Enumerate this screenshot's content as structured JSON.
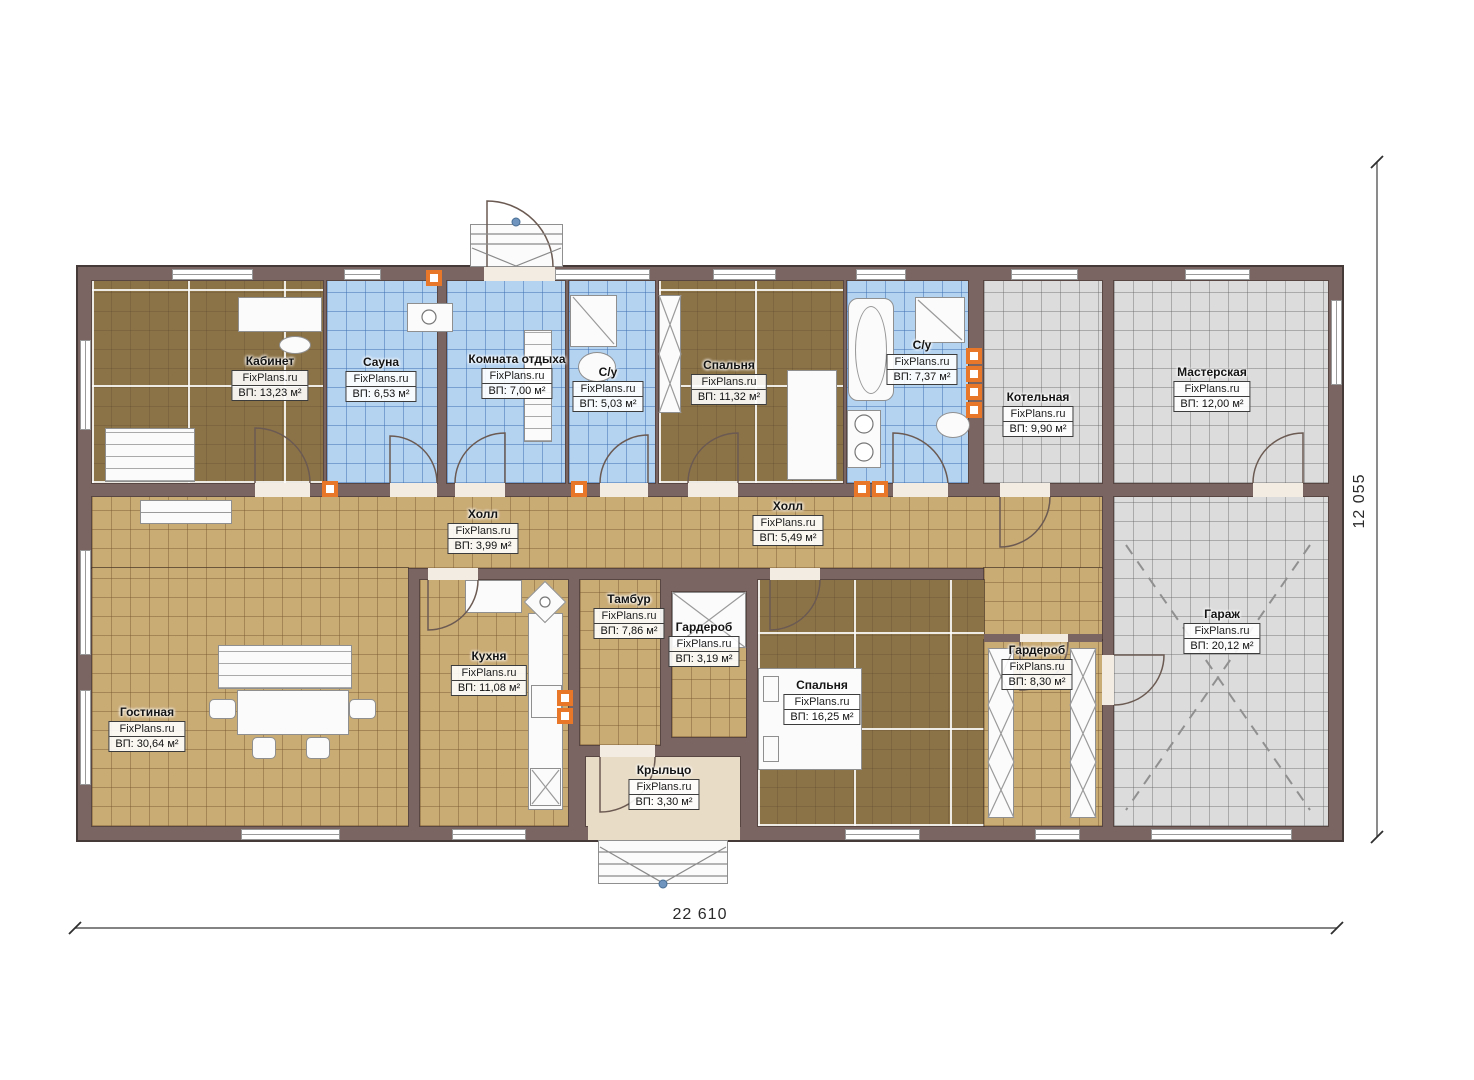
{
  "plan": {
    "watermark": "FixPlans.ru",
    "rooms": [
      {
        "id": "kabinet",
        "name": "Кабинет",
        "area": "ВП: 13,23 м²"
      },
      {
        "id": "sauna",
        "name": "Сауна",
        "area": "ВП: 6,53 м²"
      },
      {
        "id": "komnata-otdyha",
        "name": "Комната отдыха",
        "area": "ВП: 7,00 м²"
      },
      {
        "id": "su-1",
        "name": "С/у",
        "area": "ВП: 5,03 м²"
      },
      {
        "id": "spalnya-1",
        "name": "Спальня",
        "area": "ВП: 11,32 м²"
      },
      {
        "id": "su-2",
        "name": "С/у",
        "area": "ВП: 7,37 м²"
      },
      {
        "id": "kotelnaya",
        "name": "Котельная",
        "area": "ВП: 9,90 м²"
      },
      {
        "id": "masterskaya",
        "name": "Мастерская",
        "area": "ВП: 12,00 м²"
      },
      {
        "id": "holl-1",
        "name": "Холл",
        "area": "ВП: 3,99 м²"
      },
      {
        "id": "holl-2",
        "name": "Холл",
        "area": "ВП: 5,49 м²"
      },
      {
        "id": "tambur",
        "name": "Тамбур",
        "area": "ВП: 7,86 м²"
      },
      {
        "id": "garderob-1",
        "name": "Гардероб",
        "area": "ВП: 3,19 м²"
      },
      {
        "id": "kuhnya",
        "name": "Кухня",
        "area": "ВП: 11,08 м²"
      },
      {
        "id": "gostinaya",
        "name": "Гостиная",
        "area": "ВП: 30,64 м²"
      },
      {
        "id": "spalnya-2",
        "name": "Спальня",
        "area": "ВП: 16,25 м²"
      },
      {
        "id": "garderob-2",
        "name": "Гардероб",
        "area": "ВП: 8,30 м²"
      },
      {
        "id": "garazh",
        "name": "Гараж",
        "area": "ВП: 20,12 м²"
      },
      {
        "id": "kryltso",
        "name": "Крыльцо",
        "area": "ВП: 3,30 м²"
      }
    ],
    "dimensions": {
      "width": "22 610",
      "height": "12 055"
    },
    "colors": {
      "wall": "#7b6562",
      "floor_tan": "#c9ab74",
      "floor_blue": "#b4d3f1",
      "floor_gray": "#dcdcdc",
      "floor_brown": "#8c7347",
      "porch": "#e9dcc6",
      "vent_orange": "#e8772a"
    }
  }
}
